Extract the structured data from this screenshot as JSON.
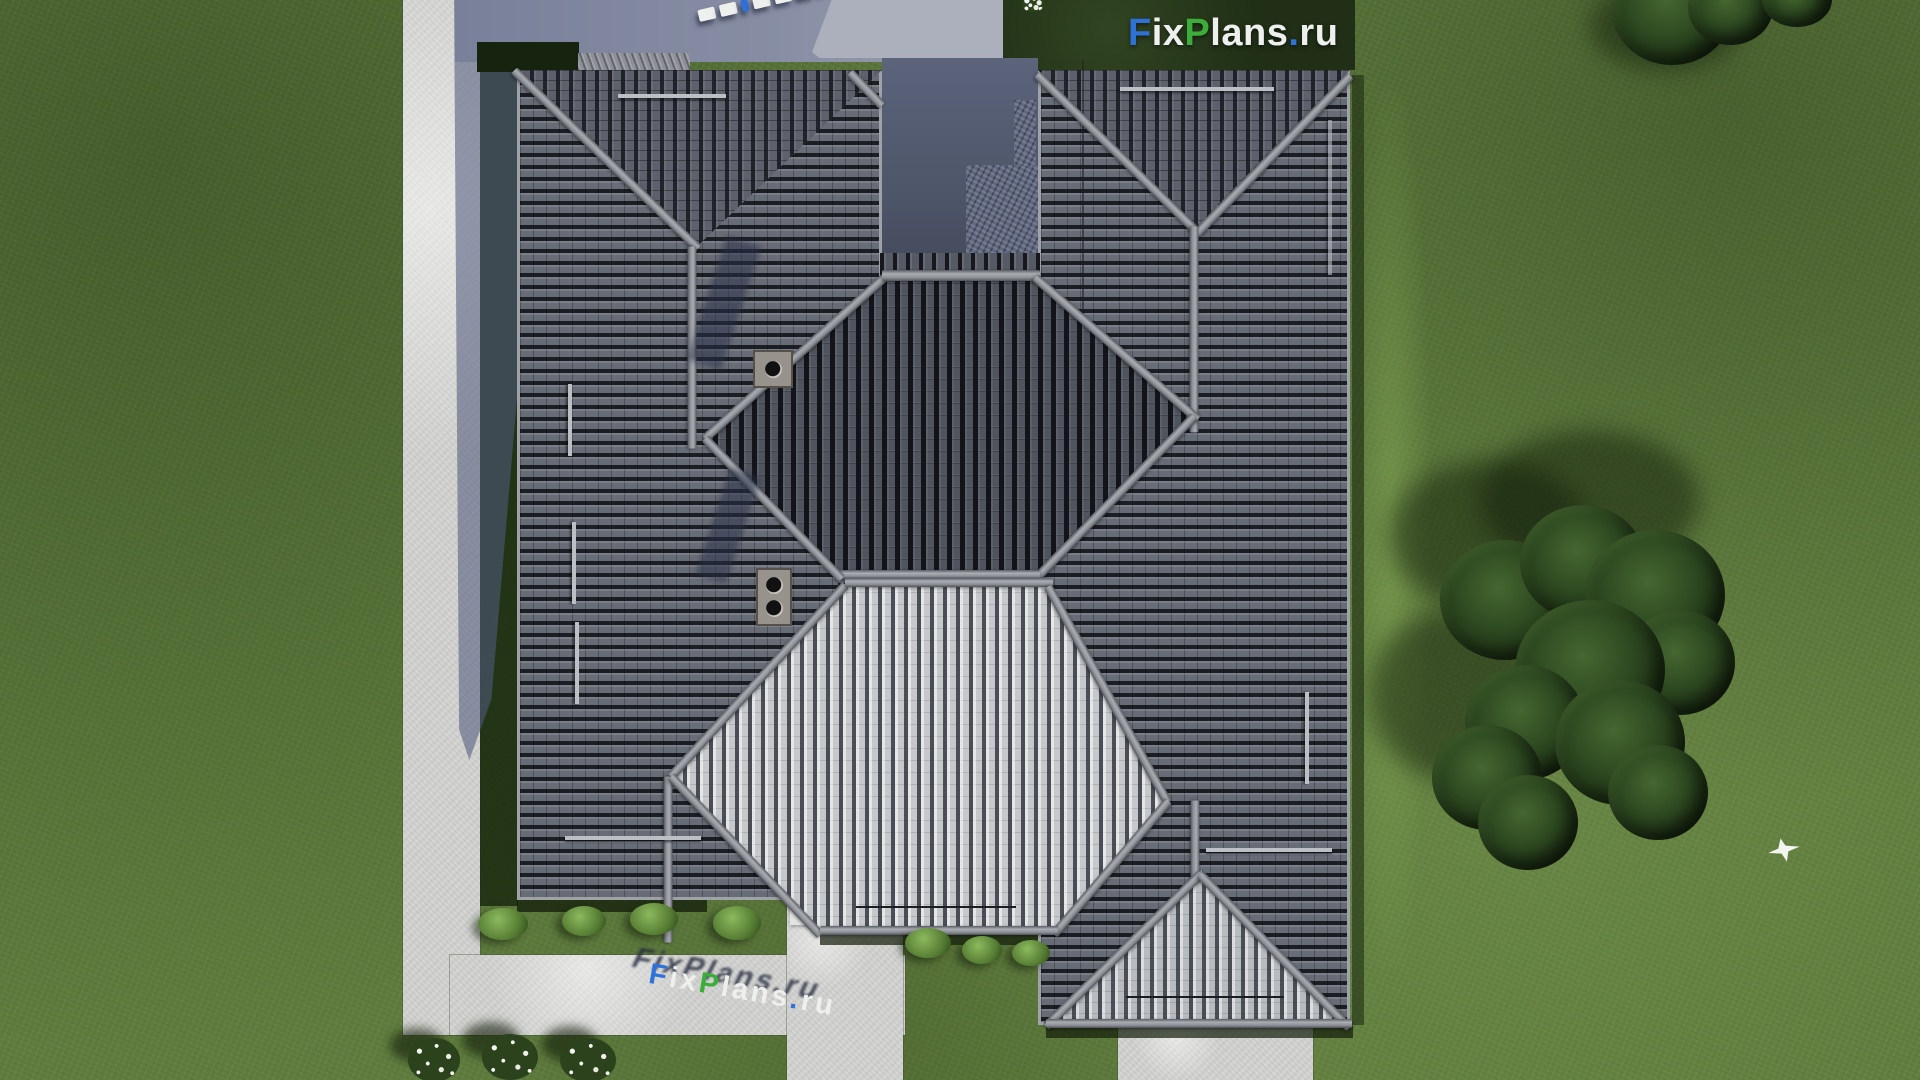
{
  "brand": {
    "text": "FixPlans.ru",
    "letters": [
      {
        "ch": "F",
        "color": "#2e71d8"
      },
      {
        "ch": "i",
        "color": "#eef0ee"
      },
      {
        "ch": "x",
        "color": "#eef0ee"
      },
      {
        "ch": "P",
        "color": "#3cad3a"
      },
      {
        "ch": "l",
        "color": "#eef0ee"
      },
      {
        "ch": "a",
        "color": "#eef0ee"
      },
      {
        "ch": "n",
        "color": "#eef0ee"
      },
      {
        "ch": "s",
        "color": "#eef0ee"
      },
      {
        "ch": ".",
        "color": "#2e71d8"
      },
      {
        "ch": "r",
        "color": "#eef0ee"
      },
      {
        "ch": "u",
        "color": "#eef0ee"
      }
    ],
    "accent_blue": "#2e71d8",
    "accent_green": "#3cad3a"
  },
  "scene": {
    "description": "Aerial top-down 3D render of a house with gray hip roofs, central dark and light octagonal roof sections, concrete walkways, lawn, trees and a flying white bird",
    "roof_color_dark": "#50545e",
    "roof_color_light": "#c6c8cc",
    "grass_color": "#5e7b3d",
    "path_color": "#d6d7d4"
  }
}
